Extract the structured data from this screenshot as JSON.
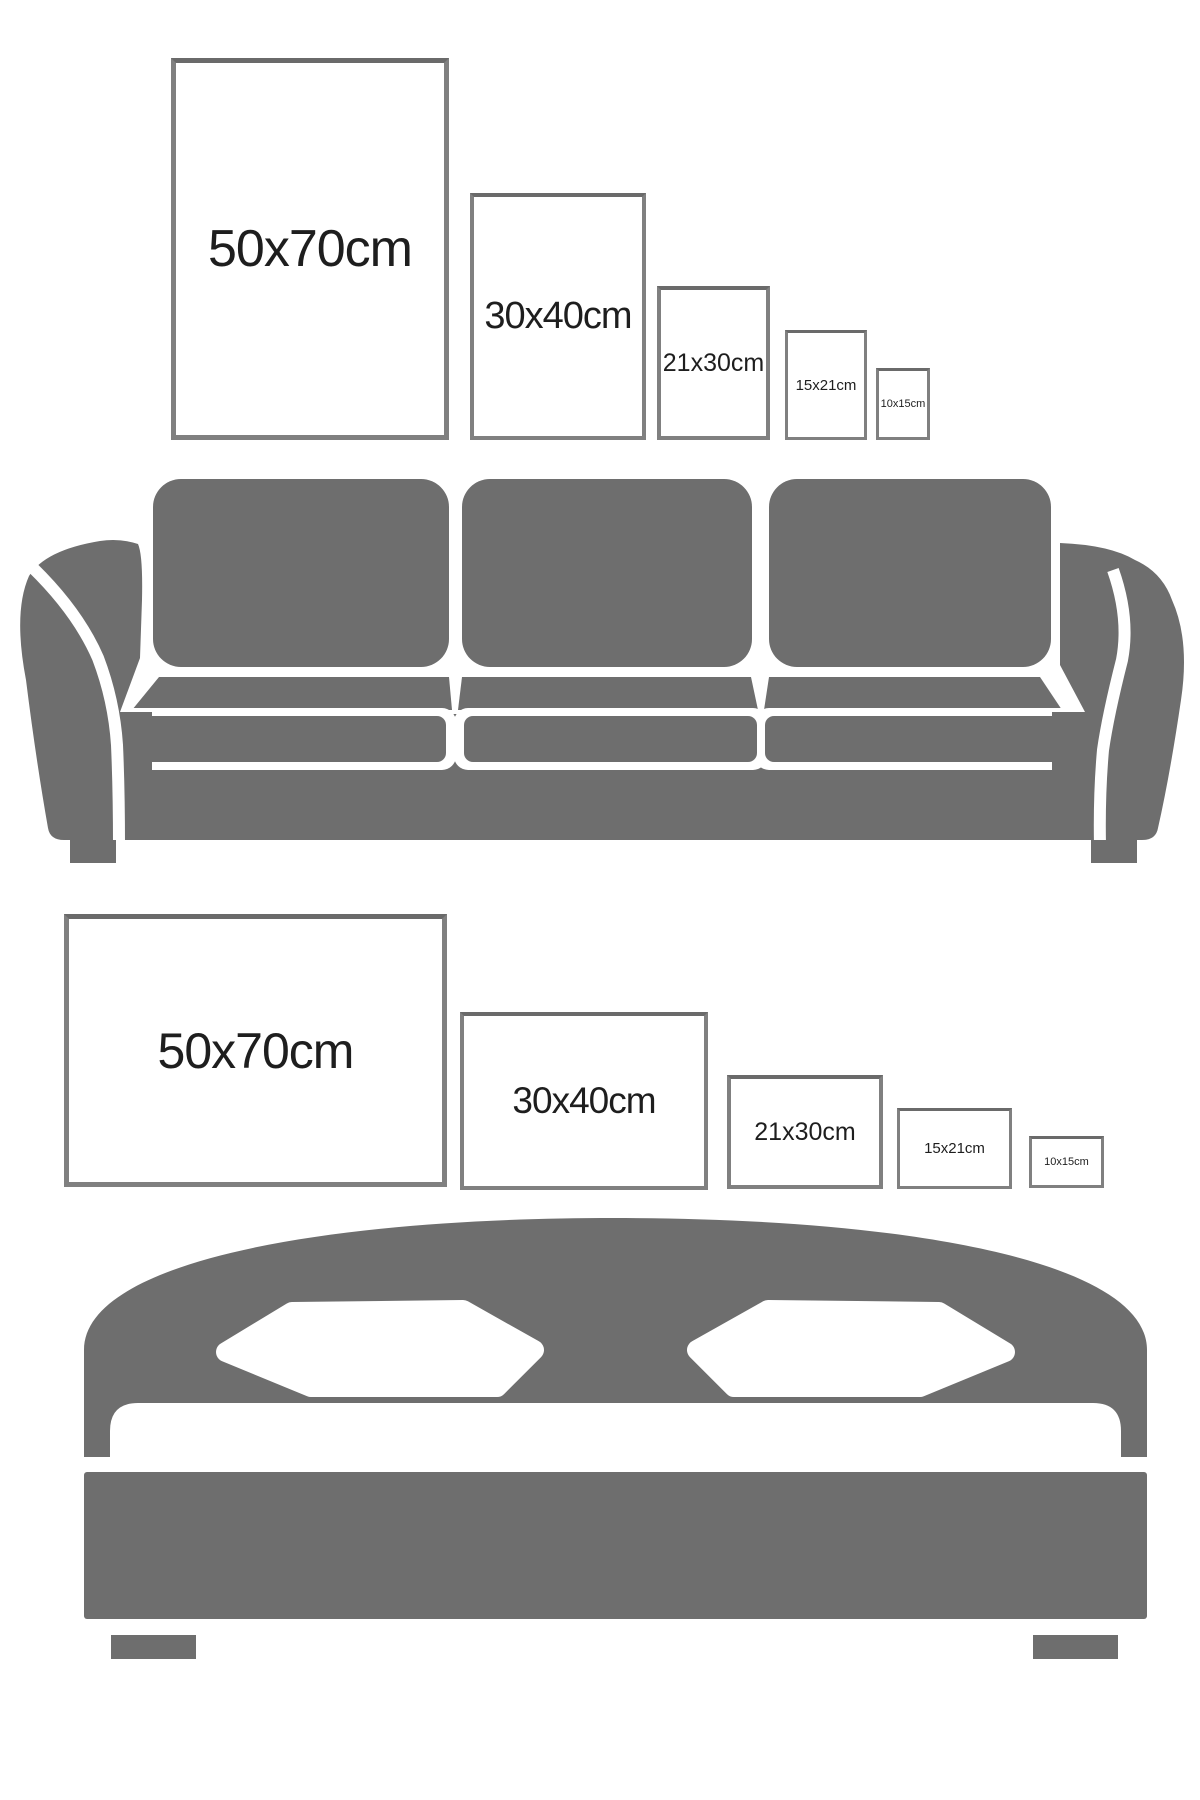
{
  "canvas": {
    "width": 1200,
    "height": 1800,
    "background": "#ffffff"
  },
  "colors": {
    "furniture_gray": "#6e6e6e",
    "frame_border": "#808080",
    "frame_border_top": "#6a6a6a",
    "label_text": "#1e1e1e"
  },
  "sofa_row": {
    "frames": [
      {
        "label": "50x70cm",
        "orientation": "portrait"
      },
      {
        "label": "30x40cm",
        "orientation": "portrait"
      },
      {
        "label": "21x30cm",
        "orientation": "portrait"
      },
      {
        "label": "15x21cm",
        "orientation": "portrait"
      },
      {
        "label": "10x15cm",
        "orientation": "portrait"
      }
    ]
  },
  "bed_row": {
    "frames": [
      {
        "label": "50x70cm",
        "orientation": "landscape"
      },
      {
        "label": "30x40cm",
        "orientation": "landscape"
      },
      {
        "label": "21x30cm",
        "orientation": "landscape"
      },
      {
        "label": "15x21cm",
        "orientation": "landscape"
      },
      {
        "label": "10x15cm",
        "orientation": "landscape"
      }
    ]
  },
  "illustrations": {
    "sofa": "sofa-illustration",
    "bed": "bed-illustration"
  }
}
